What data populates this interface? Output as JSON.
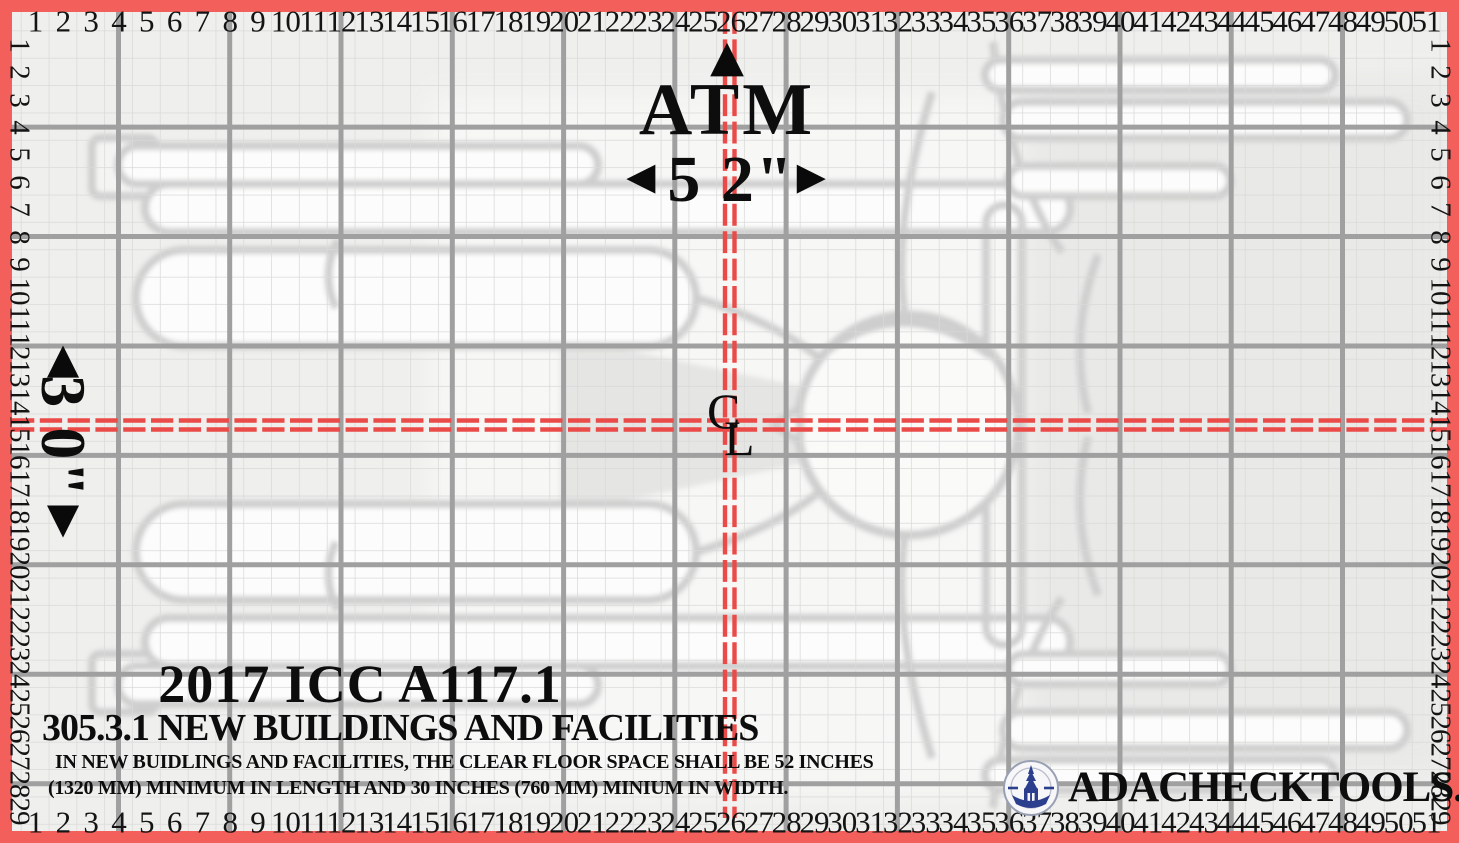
{
  "colors": {
    "border_red": "#f3605b",
    "crosshair_red": "#ea4b48",
    "major_grid": "#a0a0a0",
    "minor_grid": "#d9d9d8",
    "base": "#efefed",
    "figure_stroke": "#c9c9c9",
    "logo_blue": "#2c3e8e"
  },
  "ruler": {
    "horizontal_numbers": [
      1,
      2,
      3,
      4,
      5,
      6,
      7,
      8,
      9,
      10,
      11,
      12,
      13,
      14,
      15,
      16,
      17,
      18,
      19,
      20,
      21,
      22,
      23,
      24,
      25,
      26,
      27,
      28,
      29,
      30,
      31,
      32,
      33,
      34,
      35,
      36,
      37,
      38,
      39,
      40,
      41,
      42,
      43,
      44,
      45,
      46,
      47,
      48,
      49,
      50,
      51
    ],
    "vertical_numbers": [
      1,
      2,
      3,
      4,
      5,
      6,
      7,
      8,
      9,
      10,
      11,
      12,
      13,
      14,
      15,
      16,
      17,
      18,
      19,
      20,
      21,
      22,
      23,
      24,
      25,
      26,
      27,
      28,
      29
    ]
  },
  "dimension_top": {
    "arrow_up": "▲",
    "label": "ATM",
    "arrow_left": "◀",
    "value": "5 2\"",
    "arrow_right": "▶"
  },
  "dimension_left": {
    "arrow_up": "▲",
    "value": "3 0\"",
    "arrow_down": "▼"
  },
  "centerline": {
    "c": "C",
    "l": "L"
  },
  "title_block": {
    "code_year": "2017 ICC A117.1",
    "section": "305.3.1 NEW BUILDINGS AND FACILITIES",
    "body_line1": "IN NEW BUIDLINGS AND FACILITIES, THE CLEAR FLOOR SPACE SHALL BE 52 INCHES",
    "body_line2": "(1320 MM) MINIMUM IN LENGTH AND 30 INCHES (760 MM) MINIUM IN WIDTH."
  },
  "footer": {
    "logo": "compass-tower-logo",
    "website": "ADACHECKTOOLS.COM"
  }
}
